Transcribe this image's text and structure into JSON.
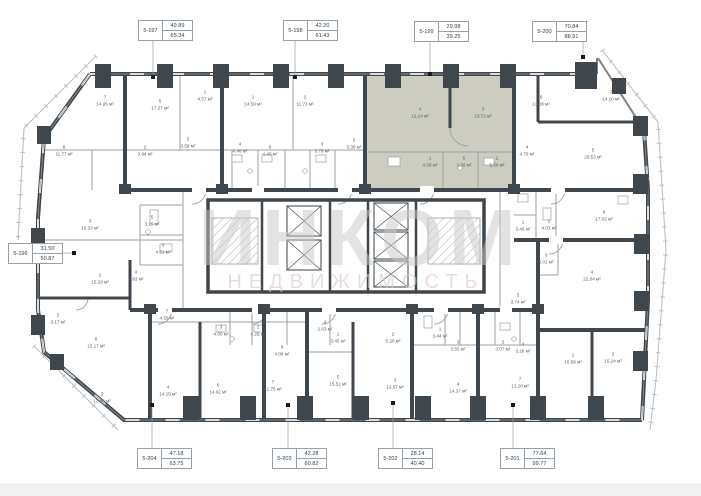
{
  "watermark": {
    "line1": "ИНКОМ",
    "line2": "НЕДВИЖИМОСТЬ"
  },
  "colors": {
    "wall": "#3f464c",
    "partition": "#9aa1a6",
    "balcony": "#bcc0c3",
    "highlight": "#cdccc1",
    "watermark_primary": "#c9c9c9",
    "watermark_secondary": "#d9c8c8",
    "leader": "#9b9b9b",
    "dot": "#1a1a1a"
  },
  "units": [
    {
      "id": "5-196",
      "top": "31.50",
      "bottom": "50.87",
      "side": "left",
      "box": [
        8,
        243
      ],
      "dot": [
        74,
        253
      ],
      "highlighted": false
    },
    {
      "id": "5-197",
      "top": "49.89",
      "bottom": "65.34",
      "side": "top",
      "box": [
        138,
        20
      ],
      "dot": [
        153,
        77
      ],
      "highlighted": false
    },
    {
      "id": "5-198",
      "top": "42.20",
      "bottom": "61.43",
      "side": "top",
      "box": [
        283,
        20
      ],
      "dot": [
        295,
        77
      ],
      "highlighted": false
    },
    {
      "id": "5-199",
      "top": "29.98",
      "bottom": "39.25",
      "side": "top",
      "box": [
        414,
        21
      ],
      "dot": [
        430,
        74
      ],
      "highlighted": true
    },
    {
      "id": "5-200",
      "top": "70.84",
      "bottom": "88.91",
      "side": "top",
      "box": [
        532,
        21
      ],
      "dot": [
        583,
        57
      ],
      "highlighted": false
    },
    {
      "id": "5-201",
      "top": "77.64",
      "bottom": "99.77",
      "side": "bottom",
      "box": [
        500,
        448
      ],
      "dot": [
        513,
        405
      ],
      "highlighted": false
    },
    {
      "id": "5-202",
      "top": "28.14",
      "bottom": "40.40",
      "side": "bottom",
      "box": [
        378,
        448
      ],
      "dot": [
        393,
        403
      ],
      "highlighted": false
    },
    {
      "id": "5-203",
      "top": "42.28",
      "bottom": "60.82",
      "side": "bottom",
      "box": [
        272,
        448
      ],
      "dot": [
        288,
        405
      ],
      "highlighted": false
    },
    {
      "id": "5-204",
      "top": "47.18",
      "bottom": "63.75",
      "side": "bottom",
      "box": [
        137,
        448
      ],
      "dot": [
        152,
        405
      ],
      "highlighted": false
    }
  ],
  "rooms": [
    {
      "x": 105,
      "y": 100,
      "n": "7",
      "a": "14.95 м²"
    },
    {
      "x": 160,
      "y": 104,
      "n": "5",
      "a": "17.27 м²"
    },
    {
      "x": 205,
      "y": 95,
      "n": "1",
      "a": "4.57 м²"
    },
    {
      "x": 253,
      "y": 100,
      "n": "1",
      "a": "14.59 м²"
    },
    {
      "x": 305,
      "y": 100,
      "n": "2",
      "a": "11.73 м²"
    },
    {
      "x": 420,
      "y": 112,
      "n": "4",
      "a": "12.14 м²"
    },
    {
      "x": 483,
      "y": 112,
      "n": "3",
      "a": "13.72 м²"
    },
    {
      "x": 541,
      "y": 100,
      "n": "6",
      "a": "13.08 м²"
    },
    {
      "x": 611,
      "y": 95,
      "n": "7",
      "a": "14.10 м²"
    },
    {
      "x": 64,
      "y": 150,
      "n": "6",
      "a": "11.77 м²"
    },
    {
      "x": 145,
      "y": 150,
      "n": "2",
      "a": "3.94 м²"
    },
    {
      "x": 188,
      "y": 142,
      "n": "3",
      "a": "3.59 м²"
    },
    {
      "x": 240,
      "y": 147,
      "n": "4",
      "a": "4.48 м²"
    },
    {
      "x": 270,
      "y": 150,
      "n": "5",
      "a": "4.40 м²"
    },
    {
      "x": 322,
      "y": 147,
      "n": "3",
      "a": "3.79 м²"
    },
    {
      "x": 354,
      "y": 143,
      "n": "5",
      "a": "3.30 м²"
    },
    {
      "x": 430,
      "y": 161,
      "n": "1",
      "a": "4.29 м²"
    },
    {
      "x": 464,
      "y": 161,
      "n": "5",
      "a": "3.66 м²"
    },
    {
      "x": 497,
      "y": 161,
      "n": "2",
      "a": "5.60 м²"
    },
    {
      "x": 527,
      "y": 150,
      "n": "4",
      "a": "4.79 м²"
    },
    {
      "x": 593,
      "y": 153,
      "n": "5",
      "a": "20.53 м²"
    },
    {
      "x": 90,
      "y": 224,
      "n": "3",
      "a": "16.33 м²"
    },
    {
      "x": 152,
      "y": 220,
      "n": "5",
      "a": "3.15 м²"
    },
    {
      "x": 163,
      "y": 248,
      "n": "3",
      "a": "4.51 м²"
    },
    {
      "x": 100,
      "y": 278,
      "n": "1",
      "a": "15.28 м²"
    },
    {
      "x": 136,
      "y": 275,
      "n": "4",
      "a": "4.63 м²"
    },
    {
      "x": 523,
      "y": 225,
      "n": "1",
      "a": "3.46 м²"
    },
    {
      "x": 549,
      "y": 224,
      "n": "2",
      "a": "4.03 м²"
    },
    {
      "x": 546,
      "y": 258,
      "n": "3",
      "a": "4.01 м²"
    },
    {
      "x": 604,
      "y": 215,
      "n": "8",
      "a": "17.02 м²"
    },
    {
      "x": 592,
      "y": 275,
      "n": "4",
      "a": "22.04 м²"
    },
    {
      "x": 58,
      "y": 318,
      "n": "2",
      "a": "3.17 м²"
    },
    {
      "x": 96,
      "y": 342,
      "n": "6",
      "a": "15.17 м²"
    },
    {
      "x": 167,
      "y": 314,
      "n": "7",
      "a": "4.50 м²"
    },
    {
      "x": 221,
      "y": 330,
      "n": "3",
      "a": "4.05 м²"
    },
    {
      "x": 258,
      "y": 330,
      "n": "2",
      "a": "4.29 м²"
    },
    {
      "x": 282,
      "y": 350,
      "n": "8",
      "a": "4.09 м²"
    },
    {
      "x": 325,
      "y": 325,
      "n": "4",
      "a": "2.63 м²"
    },
    {
      "x": 338,
      "y": 337,
      "n": "1",
      "a": "3.45 м²"
    },
    {
      "x": 393,
      "y": 337,
      "n": "2",
      "a": "5.20 м²"
    },
    {
      "x": 440,
      "y": 332,
      "n": "1",
      "a": "3.44 м²"
    },
    {
      "x": 458,
      "y": 345,
      "n": "3",
      "a": "3.55 м²"
    },
    {
      "x": 503,
      "y": 345,
      "n": "2",
      "a": "3.07 м²"
    },
    {
      "x": 523,
      "y": 347,
      "n": "4",
      "a": "3.26 м²"
    },
    {
      "x": 518,
      "y": 298,
      "n": "5",
      "a": "3.74 м²"
    },
    {
      "x": 102,
      "y": 397,
      "n": "3",
      "a": "13.86 м²"
    },
    {
      "x": 168,
      "y": 390,
      "n": "4",
      "a": "14.15 м²"
    },
    {
      "x": 218,
      "y": 388,
      "n": "6",
      "a": "14.62 м²"
    },
    {
      "x": 273,
      "y": 385,
      "n": "7",
      "a": "11.75 м²"
    },
    {
      "x": 338,
      "y": 380,
      "n": "5",
      "a": "15.51 м²"
    },
    {
      "x": 395,
      "y": 383,
      "n": "3",
      "a": "13.57 м²"
    },
    {
      "x": 458,
      "y": 387,
      "n": "4",
      "a": "14.37 м²"
    },
    {
      "x": 520,
      "y": 382,
      "n": "7",
      "a": "13.26 м²"
    },
    {
      "x": 573,
      "y": 358,
      "n": "1",
      "a": "16.59 м²"
    },
    {
      "x": 613,
      "y": 357,
      "n": "2",
      "a": "15.24 м²"
    }
  ]
}
